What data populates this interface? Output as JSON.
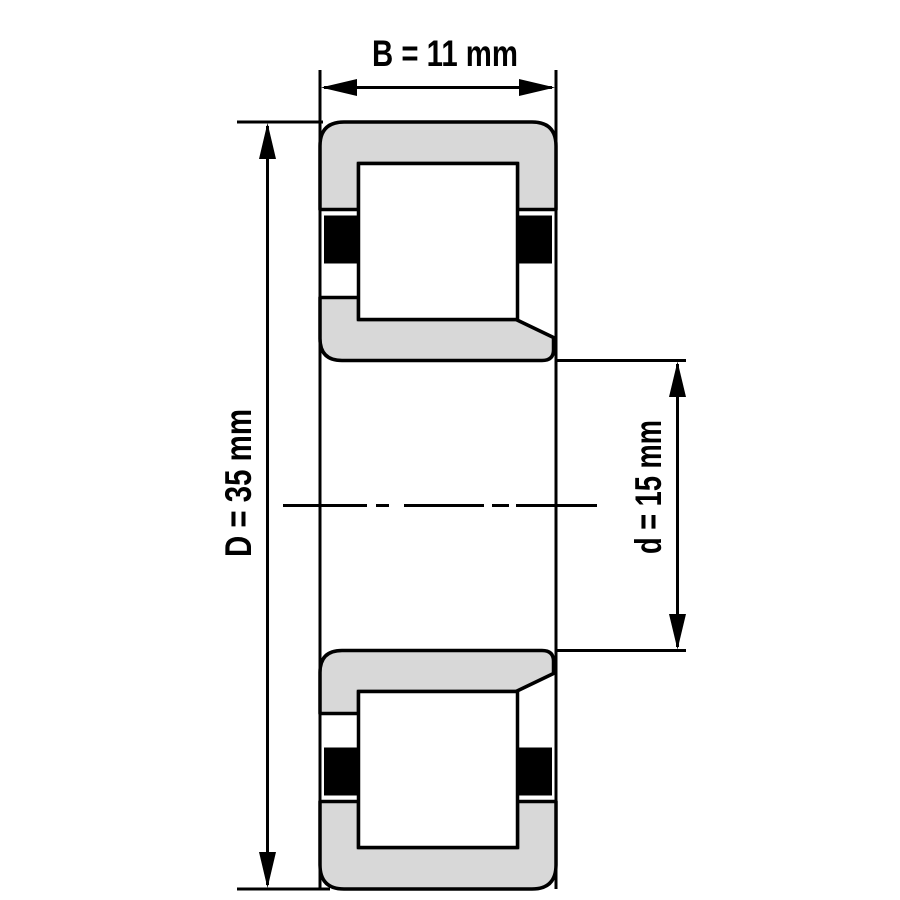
{
  "diagram": {
    "labels": {
      "width": "B = 11 mm",
      "outer_diameter": "D = 35 mm",
      "bore_diameter": "d = 15 mm"
    },
    "values": {
      "B_mm": 11,
      "D_mm": 35,
      "d_mm": 15
    },
    "colors": {
      "background": "#ffffff",
      "line": "#000000",
      "ring_fill": "#d8d8d8",
      "roller_fill": "#ffffff",
      "cage_fill": "#000000"
    }
  }
}
